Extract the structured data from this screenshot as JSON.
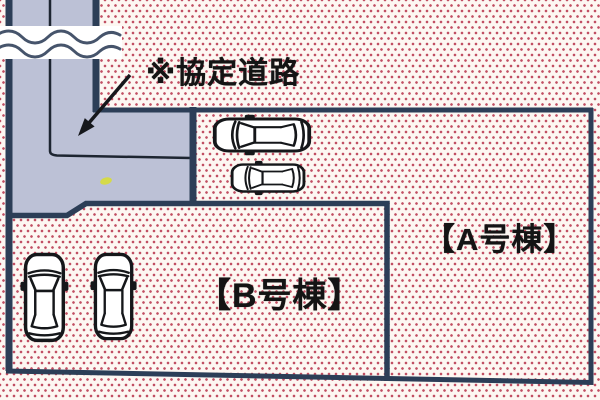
{
  "site_plan": {
    "road_label": "※協定道路",
    "lots": [
      {
        "id": "A",
        "label": "【A号棟】",
        "parking_cars_shown": 2
      },
      {
        "id": "B",
        "label": "【B号棟】",
        "parking_cars_shown": 2
      }
    ],
    "icons": {
      "car_icon": "top-view-car-outline",
      "break_icon": "wavy-road-continuation-break",
      "arrow_icon": "arrow-pointing-to-agreement-road"
    }
  },
  "colors": {
    "background": "#fdf7f2",
    "dot": "#c14f63",
    "outline_navy": "#2c3e57",
    "road_fill": "#bcc1d6",
    "road_inner_line": "#1d2531",
    "wave_stroke": "#46546b",
    "wave_band": "#ffffff",
    "arrow": "#16181c",
    "car_stroke": "#15171a",
    "speck_yellow": "#d5da49",
    "text": "#141414"
  }
}
